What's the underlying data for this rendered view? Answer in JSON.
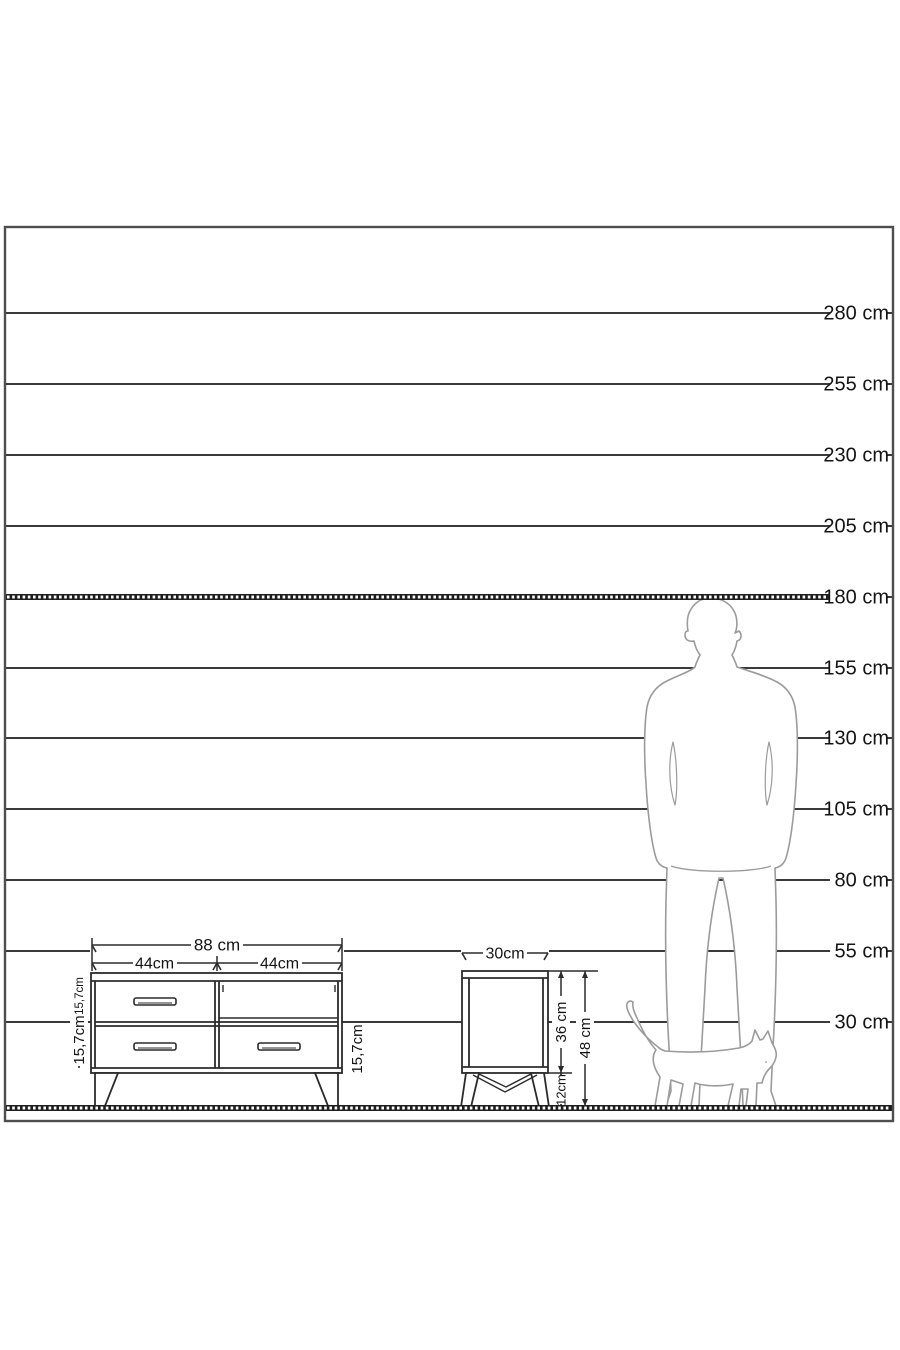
{
  "scale": {
    "labels": [
      "280 cm",
      "255 cm",
      "230 cm",
      "205 cm",
      "180 cm",
      "155 cm",
      "130 cm",
      "105 cm",
      "80 cm",
      "55 cm",
      "30 cm"
    ],
    "values_cm": [
      280,
      255,
      230,
      205,
      180,
      155,
      130,
      105,
      80,
      55,
      30
    ],
    "emphasized_value_cm": 180,
    "unit": "cm"
  },
  "tv_stand": {
    "width_label": "88 cm",
    "section_width_labels": [
      "44cm",
      "44cm"
    ],
    "row_height_labels": [
      "15,7cm",
      "15,7cm",
      "15,7cm"
    ]
  },
  "nightstand": {
    "width_label": "30cm",
    "body_height_label": "36 cm",
    "leg_height_label": "12cm",
    "total_height_label": "48 cm"
  },
  "figures": {
    "man": "man-silhouette",
    "cat": "cat-silhouette"
  },
  "colors": {
    "line": "#3a3a3a",
    "text": "#141414",
    "furniture_stroke": "#2b2b2b",
    "silhouette_stroke": "#9b9b9b",
    "border": "#4e4e4e",
    "thick_line": "#1e1e1e",
    "background": "#ffffff"
  }
}
